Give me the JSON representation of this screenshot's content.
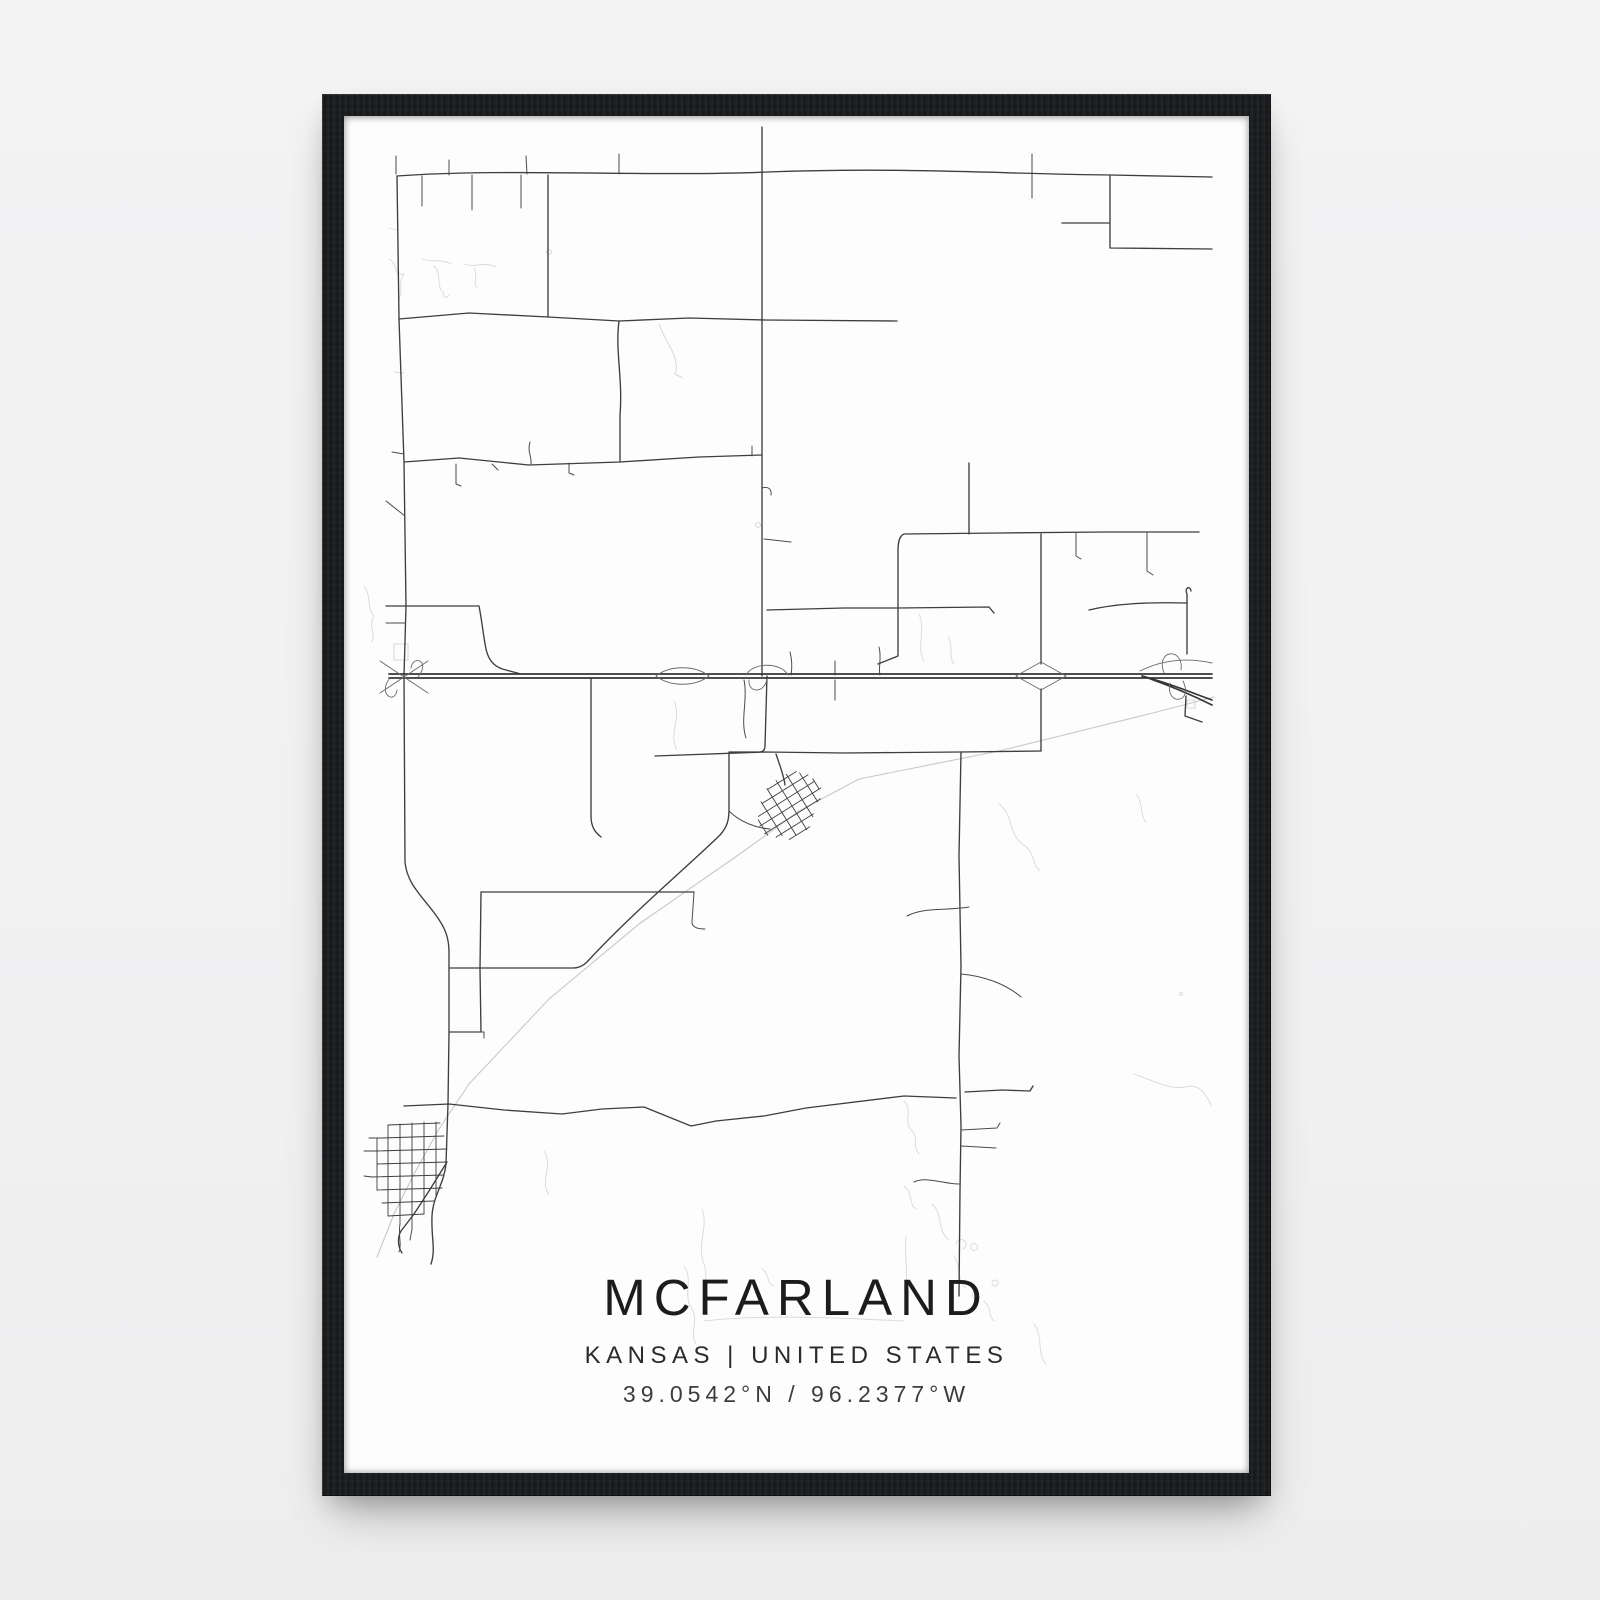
{
  "scene": {
    "background_color": "#f1f1f2"
  },
  "frame": {
    "color": "#1a1c1e",
    "material": "black wood"
  },
  "poster": {
    "background_color": "#fdfdfd",
    "title": "MCFARLAND",
    "subtitle": "KANSAS | UNITED STATES",
    "coordinates": "39.0542°N / 96.2377°W"
  },
  "map": {
    "road_color": "#3e3e3e",
    "highway_color": "#353535",
    "railroad_color": "#c8c8c8",
    "creek_color": "#d9d9d9"
  }
}
